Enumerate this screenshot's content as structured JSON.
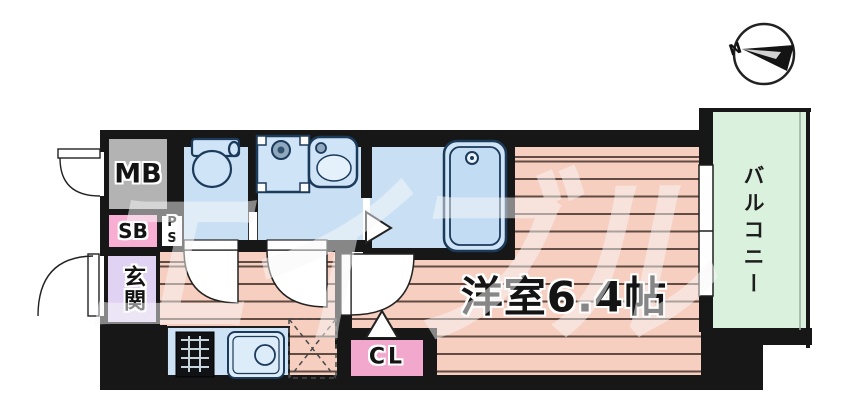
{
  "plan": {
    "labels": {
      "meter_box": "MB",
      "shoe_box": "SB",
      "pipe_space": "PS",
      "entrance": "玄関",
      "closet": "CL",
      "main_room": "洋室6.4帖",
      "balcony": "バルコニー"
    },
    "compass": {
      "north": "N"
    },
    "watermark": "エイブル",
    "colors": {
      "wall": "#171717",
      "wet_area_floor": "#c9e0f4",
      "fixture_stroke": "#1c3a5a",
      "wood_floor": "#f6cfc0",
      "floor_line": "#48342c",
      "balcony_floor": "#daf2dd",
      "meter_box": "#b3b3b3",
      "shoe_box": "#f7aed2",
      "closet": "#f2a8cd",
      "entrance": "#e0d2f2",
      "kitchen_counter": "#cde2f4"
    }
  }
}
